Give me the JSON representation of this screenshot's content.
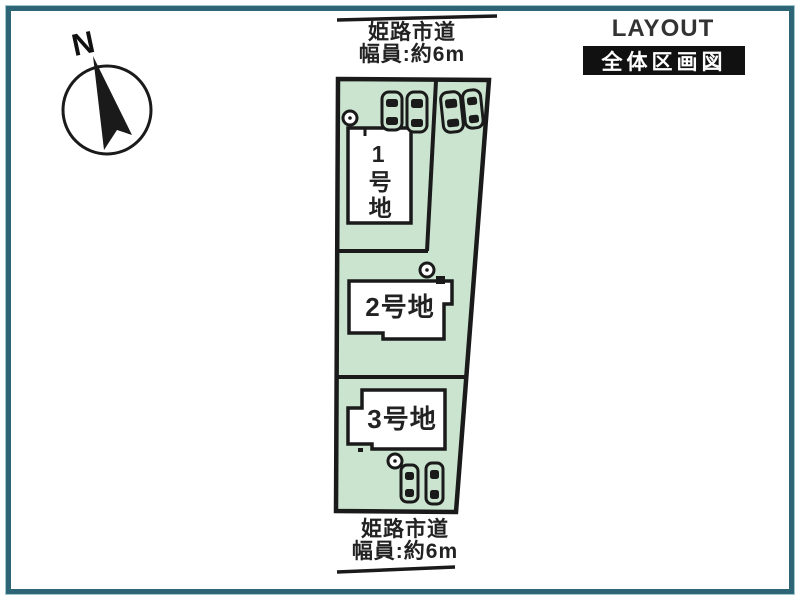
{
  "header": {
    "title_en": "LAYOUT PLAN",
    "title_ja": "全体区画図"
  },
  "compass": {
    "label": "N"
  },
  "roads": {
    "top": {
      "name": "姫路市道",
      "width_label": "幅員:約6m"
    },
    "bottom": {
      "name": "姫路市道",
      "width_label": "幅員:約6m"
    }
  },
  "parcels": [
    {
      "label": "1号地"
    },
    {
      "label": "2号地"
    },
    {
      "label": "3号地"
    }
  ],
  "colors": {
    "frame": "#2d6576",
    "parcel_fill": "#cbe4d0",
    "outline": "#1a1a1a",
    "building_fill": "#ffffff",
    "title_box_bg": "#111111"
  }
}
